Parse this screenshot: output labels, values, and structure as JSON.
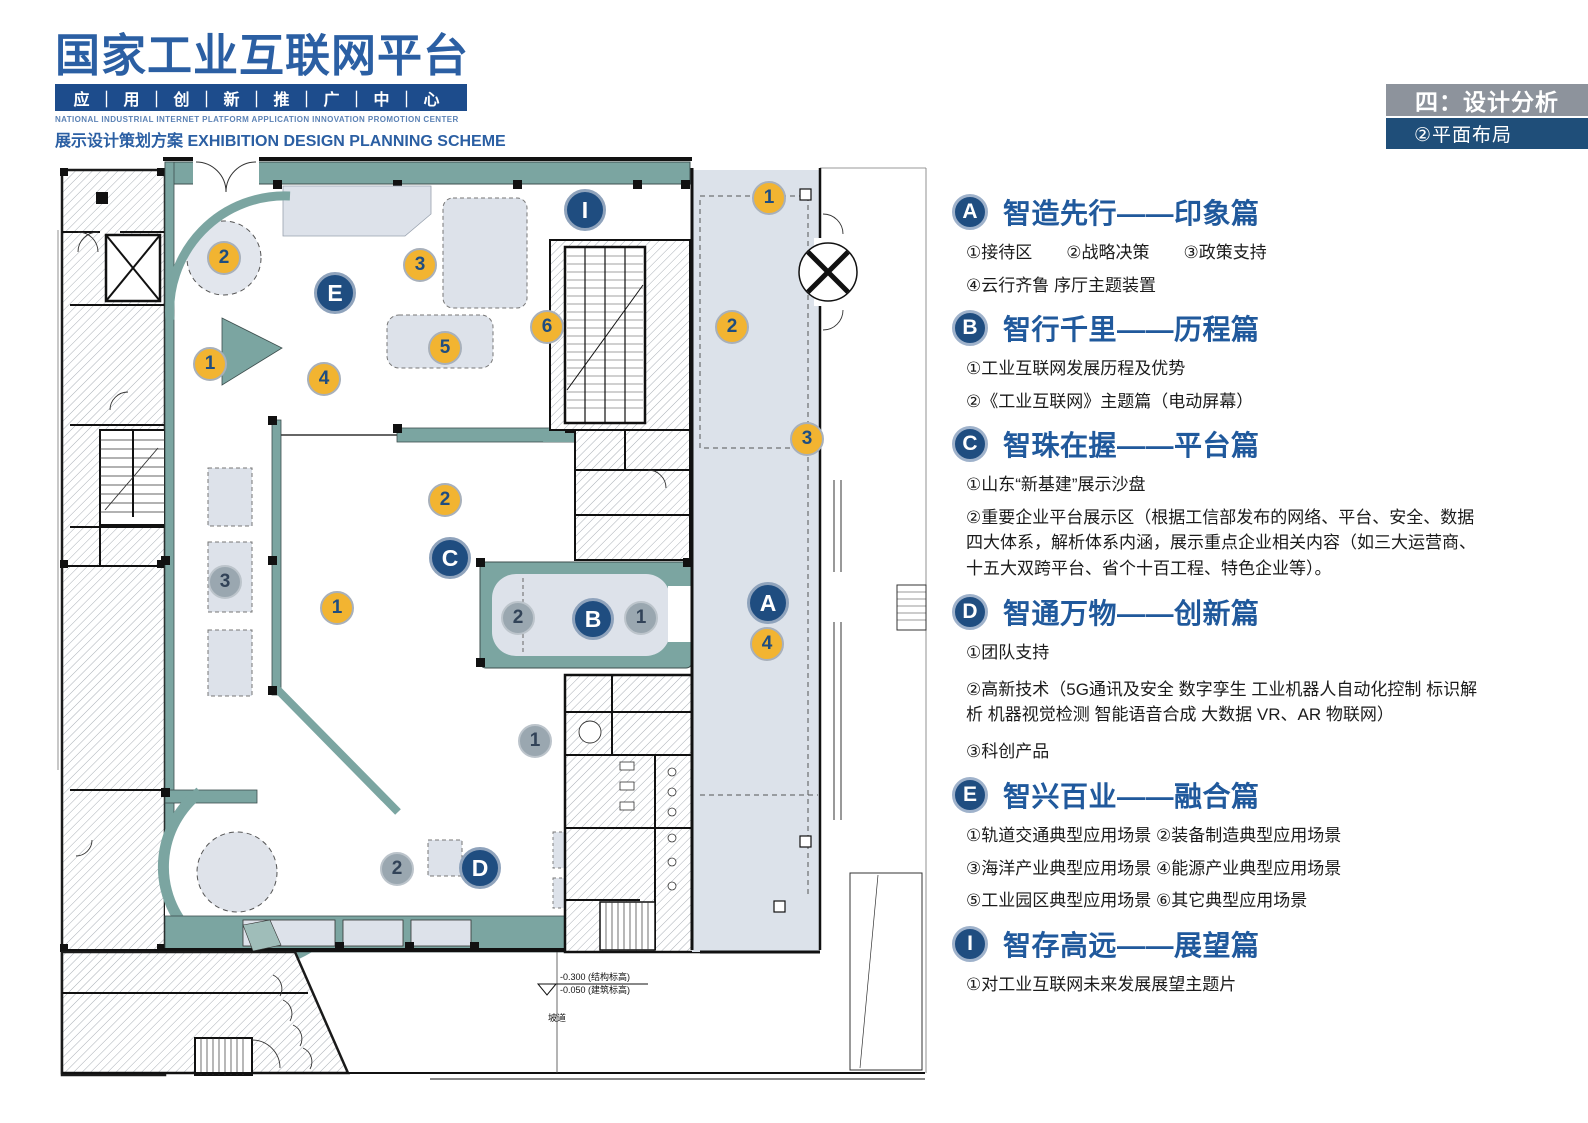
{
  "header": {
    "logo_title": "国家工业互联网平台",
    "logo_subtitle": "应｜用｜创｜新｜推｜广｜中｜心",
    "logo_english": "NATIONAL INDUSTRIAL INTERNET PLATFORM APPLICATION INNOVATION PROMOTION CENTER",
    "scheme_cn": "展示设计策划方案",
    "scheme_en": "EXHIBITION DESIGN PLANNING SCHEME"
  },
  "page_tabs": {
    "section_label": "四：设计分析",
    "sub_label": "②平面布局"
  },
  "legend_sections": [
    {
      "badge": "A",
      "title": "智造先行——印象篇",
      "lines": [
        "①接待区　　②战略决策　　③政策支持",
        "④云行齐鲁 序厅主题装置"
      ]
    },
    {
      "badge": "B",
      "title": "智行千里——历程篇",
      "lines": [
        "①工业互联网发展历程及优势",
        "②《工业互联网》主题篇（电动屏幕）"
      ]
    },
    {
      "badge": "C",
      "title": "智珠在握——平台篇",
      "lines": [
        "①山东“新基建”展示沙盘",
        "②重要企业平台展示区（根据工信部发布的网络、平台、安全、数据四大体系，解析体系内涵，展示重点企业相关内容（如三大运营商、十五大双跨平台、省个十百工程、特色企业等）。"
      ]
    },
    {
      "badge": "D",
      "title": "智通万物——创新篇",
      "lines": [
        "①团队支持",
        "②高新技术（5G通讯及安全 数字孪生 工业机器人自动化控制 标识解析 机器视觉检测 智能语音合成 大数据 VR、AR 物联网）",
        "③科创产品"
      ]
    },
    {
      "badge": "E",
      "title": "智兴百业——融合篇",
      "lines": [
        "①轨道交通典型应用场景 ②装备制造典型应用场景",
        "③海洋产业典型应用场景 ④能源产业典型应用场景",
        "⑤工业园区典型应用场景 ⑥其它典型应用场景"
      ]
    },
    {
      "badge": "I",
      "title": "智存高远——展望篇",
      "lines": [
        "①对工业互联网未来发展展望主题片"
      ]
    }
  ],
  "floor_plan": {
    "level_annotation": {
      "line1": "-0.300 (结构标高)",
      "line2": "-0.050 (建筑标高)",
      "ramp_label": "坡道"
    },
    "colors": {
      "wall_teal": "#7BA5A1",
      "zone_light": "#DDE2EA",
      "marker_gold": "#F2B431",
      "marker_blue": "#1F4D80",
      "marker_gray": "#9AA7B0"
    },
    "markers": [
      {
        "label": "I",
        "type": "section",
        "x": 585,
        "y": 210
      },
      {
        "label": "E",
        "type": "section",
        "x": 335,
        "y": 293
      },
      {
        "label": "C",
        "type": "section",
        "x": 450,
        "y": 558
      },
      {
        "label": "B",
        "type": "section",
        "x": 593,
        "y": 619
      },
      {
        "label": "A",
        "type": "section",
        "x": 768,
        "y": 603
      },
      {
        "label": "D",
        "type": "section",
        "x": 480,
        "y": 868
      },
      {
        "label": "2",
        "type": "gold",
        "x": 224,
        "y": 258
      },
      {
        "label": "3",
        "type": "gold",
        "x": 420,
        "y": 265
      },
      {
        "label": "6",
        "type": "gold",
        "x": 547,
        "y": 327
      },
      {
        "label": "5",
        "type": "gold",
        "x": 445,
        "y": 348
      },
      {
        "label": "1",
        "type": "gold",
        "x": 210,
        "y": 364
      },
      {
        "label": "4",
        "type": "gold",
        "x": 324,
        "y": 379
      },
      {
        "label": "1",
        "type": "gold",
        "x": 769,
        "y": 198
      },
      {
        "label": "2",
        "type": "gold",
        "x": 732,
        "y": 327
      },
      {
        "label": "3",
        "type": "gold",
        "x": 807,
        "y": 439
      },
      {
        "label": "2",
        "type": "gold",
        "x": 445,
        "y": 500
      },
      {
        "label": "1",
        "type": "gold",
        "x": 337,
        "y": 608
      },
      {
        "label": "4",
        "type": "gold",
        "x": 767,
        "y": 644
      },
      {
        "label": "3",
        "type": "gray",
        "x": 225,
        "y": 582
      },
      {
        "label": "2",
        "type": "gray",
        "x": 518,
        "y": 618
      },
      {
        "label": "1",
        "type": "gray",
        "x": 641,
        "y": 618
      },
      {
        "label": "1",
        "type": "gray",
        "x": 535,
        "y": 741
      },
      {
        "label": "2",
        "type": "gray",
        "x": 397,
        "y": 869
      }
    ]
  }
}
